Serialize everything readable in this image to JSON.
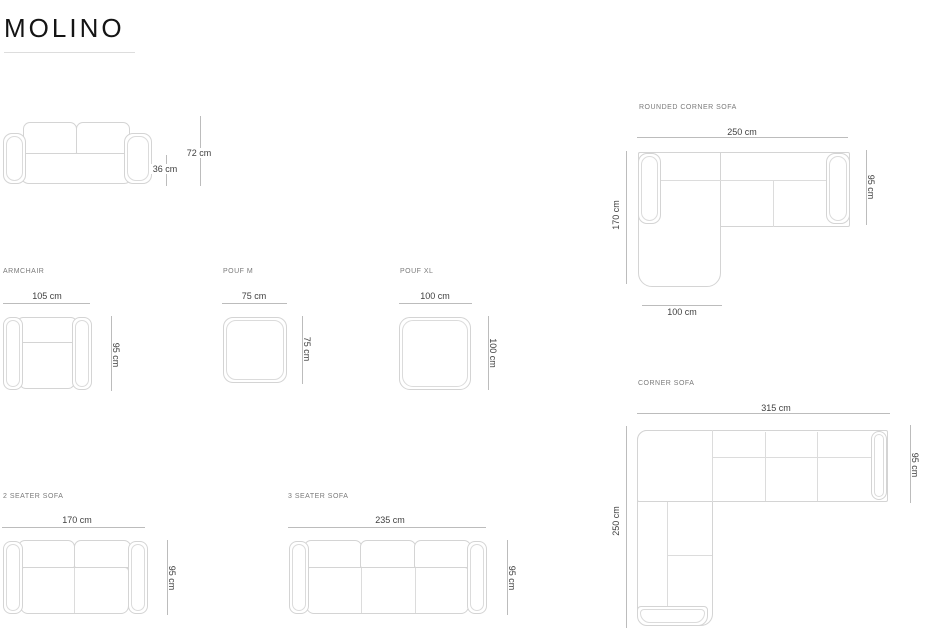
{
  "page": {
    "title": "MOLINO"
  },
  "products": {
    "sofa_front": {
      "total_height": "72 cm",
      "seat_height": "36 cm"
    },
    "rounded_corner_sofa": {
      "label": "ROUNDED CORNER SOFA",
      "width": "250 cm",
      "depth": "95 cm",
      "length": "170 cm",
      "chaise_width": "100 cm"
    },
    "armchair": {
      "label": "ARMCHAIR",
      "width": "105 cm",
      "depth": "95 cm"
    },
    "pouf_m": {
      "label": "POUF M",
      "width": "75 cm",
      "depth": "75 cm"
    },
    "pouf_xl": {
      "label": "POUF XL",
      "width": "100 cm",
      "depth": "100 cm"
    },
    "corner_sofa": {
      "label": "CORNER SOFA",
      "width": "315 cm",
      "depth": "95 cm",
      "length": "250 cm"
    },
    "two_seater_sofa": {
      "label": "2 SEATER SOFA",
      "width": "170 cm",
      "depth": "95 cm"
    },
    "three_seater_sofa": {
      "label": "3 SEATER SOFA",
      "width": "235 cm",
      "depth": "95 cm"
    }
  },
  "colors": {
    "title_text": "#141414",
    "label_text": "#7a7a7a",
    "dimension_text": "#3f3f3f",
    "drawing_line": "#d4d4d4",
    "dimension_line": "#bcbcbc"
  }
}
